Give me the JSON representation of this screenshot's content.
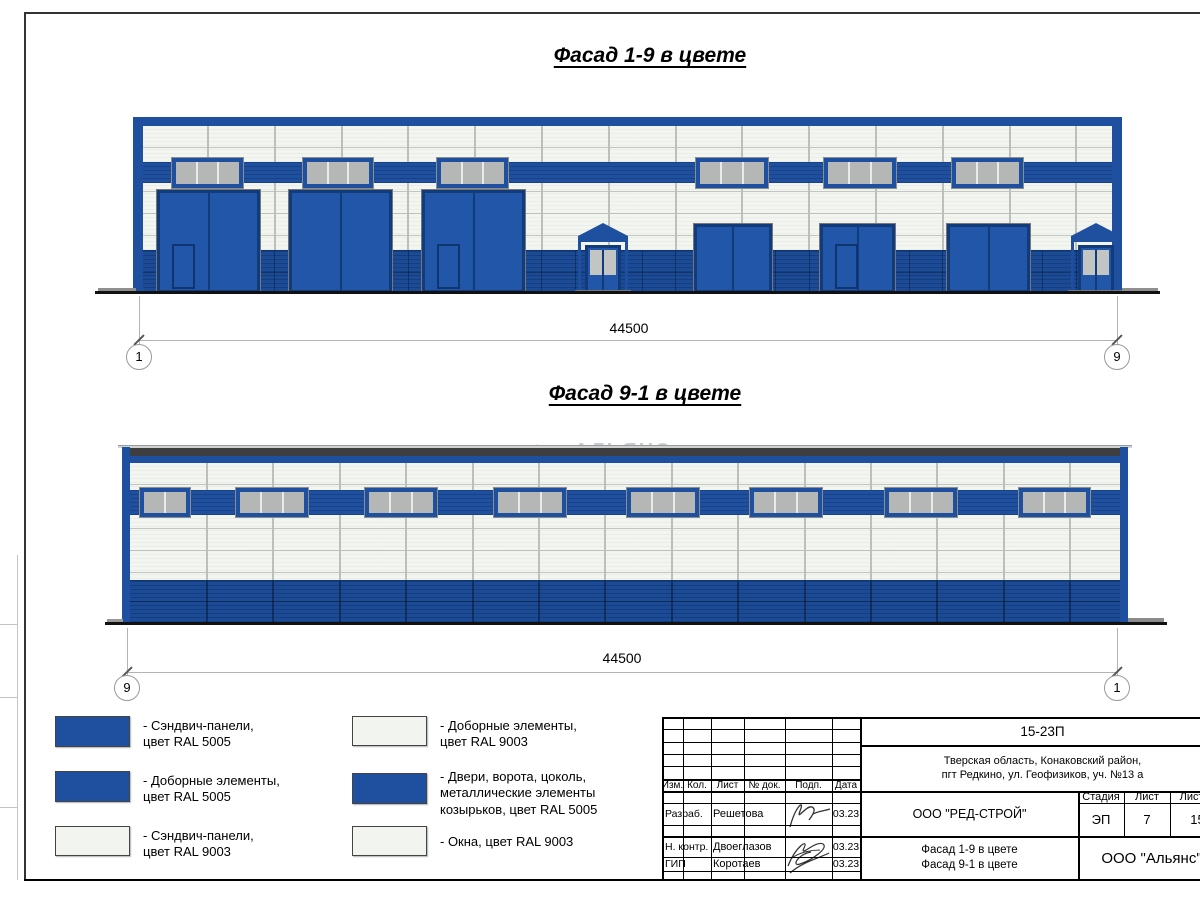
{
  "colors": {
    "ral5005_blue": "#1e509f",
    "ral9003_white": "#f2f4ef",
    "window_gray": "#b4b7b5",
    "dark_roof_strip": "#3e3e40"
  },
  "titles": {
    "facade_1_9": "Фасад 1-9 в цвете",
    "facade_9_1": "Фасад 9-1 в цвете"
  },
  "facade19_dim": {
    "value": "44500",
    "axis_left": "1",
    "axis_right": "9"
  },
  "facade91_dim": {
    "value": "44500",
    "axis_left": "9",
    "axis_right": "1"
  },
  "watermark": {
    "text": "АЛЬЯНС"
  },
  "legend": {
    "items": [
      {
        "swatch": "blue",
        "text": "- Сэндвич-панели,\nцвет RAL 5005"
      },
      {
        "swatch": "blue",
        "text": "- Доборные элементы,\nцвет RAL 5005"
      },
      {
        "swatch": "white",
        "text": "- Сэндвич-панели,\nцвет RAL 9003"
      },
      {
        "swatch": "white",
        "text": "- Доборные элементы,\nцвет RAL 9003"
      },
      {
        "swatch": "blue",
        "text": "- Двери, ворота, цоколь,\nметаллические элементы\nкозырьков, цвет RAL 5005"
      },
      {
        "swatch": "white",
        "text": "- Окна, цвет RAL 9003"
      }
    ]
  },
  "title_block": {
    "doc_number": "15-23П",
    "address": "Тверская область, Конаковский район,\nпгт Редкино, ул. Геофизиков, уч. №13 а",
    "columns": [
      "Изм.",
      "Кол.",
      "Лист",
      "№ док.",
      "Подп.",
      "Дата"
    ],
    "rows": [
      {
        "role": "Разраб.",
        "name": "Решетова",
        "date": "03.23"
      },
      {
        "role": "Н. контр.",
        "name": "Двоеглазов",
        "date": "03.23"
      },
      {
        "role": "ГИП",
        "name": "Коротаев",
        "date": "03.23"
      }
    ],
    "company": "ООО \"РЕД-СТРОЙ\"",
    "stage_label": "Стадия",
    "sheet_label": "Лист",
    "sheets_label": "Листов",
    "stage": "ЭП",
    "sheet_no": "7",
    "sheets_total": "15",
    "sheet_title": "Фасад 1-9 в цвете\nФасад 9-1 в цвете",
    "organization": "ООО \"Альянс\""
  }
}
